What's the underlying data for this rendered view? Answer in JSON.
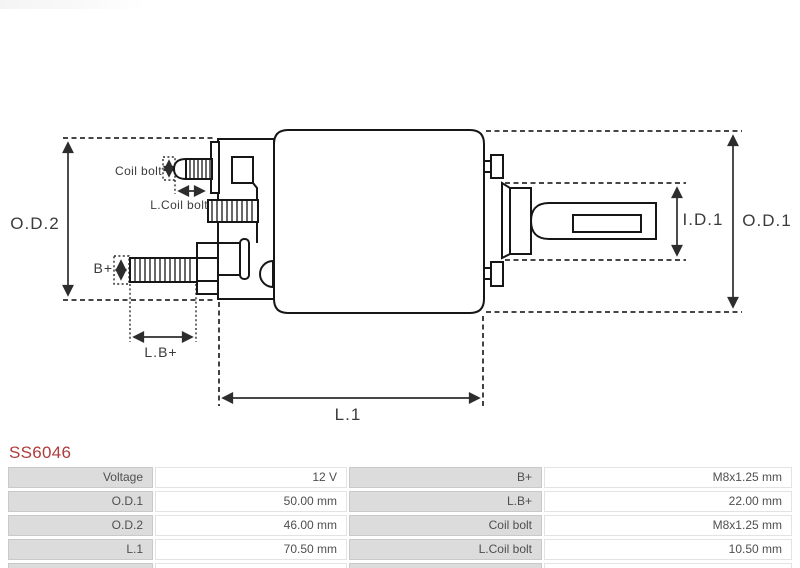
{
  "part_number": "SS6046",
  "diagram": {
    "labels": {
      "od2": "O.D.2",
      "od1": "O.D.1",
      "id1": "I.D.1",
      "l1": "L.1",
      "lb_plus": "L.B+",
      "b_plus": "B+",
      "coil_bolt": "Coil bolt",
      "l_coil_bolt": "L.Coil bolt"
    }
  },
  "table": {
    "rows": [
      {
        "label1": "Voltage",
        "value1": "12 V",
        "label2": "B+",
        "value2": "M8x1.25 mm"
      },
      {
        "label1": "O.D.1",
        "value1": "50.00 mm",
        "label2": "L.B+",
        "value2": "22.00 mm"
      },
      {
        "label1": "O.D.2",
        "value1": "46.00 mm",
        "label2": "Coil bolt",
        "value2": "M8x1.25 mm"
      },
      {
        "label1": "L.1",
        "value1": "70.50 mm",
        "label2": "L.Coil bolt",
        "value2": "10.50 mm"
      }
    ]
  },
  "colors": {
    "part_number": "#b03c3c",
    "outline": "#161616",
    "dimension": "#2d2d2d",
    "table_label_bg": "#dcdcdc",
    "table_value_bg": "#ffffff",
    "table_text": "#4f4f4f"
  }
}
